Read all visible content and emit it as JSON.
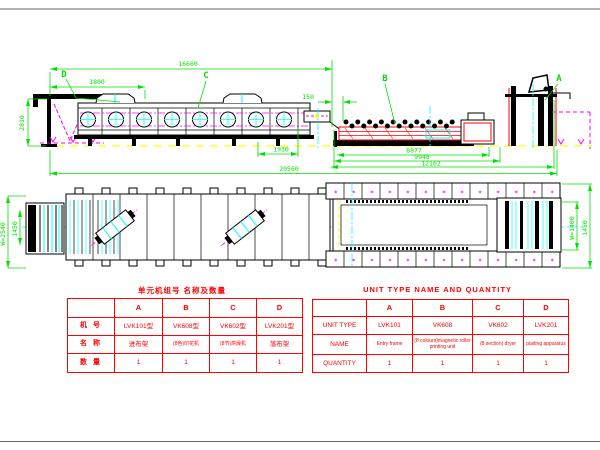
{
  "drawing": {
    "view_labels": {
      "a": "A",
      "b": "B",
      "c": "C",
      "d": "D"
    },
    "dimensions": {
      "overall_top": "16660",
      "entry_offset": "1800",
      "machine_height": "2810",
      "unit_gap": "150",
      "exit_length": "1930",
      "printing_length": "8877",
      "printing_overall": "9948",
      "right_group_overall": "12162",
      "overall_bottom": "20560",
      "plan_left_outer": "W=2540",
      "plan_left_inner": "1450",
      "plan_right_inner": "W=1400",
      "plan_right_outer": "1450"
    },
    "marks_row": "* * * * * * * * * * * * *"
  },
  "colors": {
    "dimension_green": "#00e000",
    "outline_black": "#000000",
    "table_red": "#ff0000",
    "path_magenta": "#ff00ff",
    "detail_cyan": "#00ffff",
    "ground_yellow": "#ffff00"
  },
  "tables": {
    "cn": {
      "title": "单元机组号 名称及数量",
      "col_headers": [
        "A",
        "B",
        "C",
        "D"
      ],
      "rows": [
        {
          "label": "机 号",
          "values": [
            "LVK101型",
            "VK608型",
            "VK602型",
            "LVK201型"
          ]
        },
        {
          "label": "名 称",
          "values": [
            "进布架",
            "(8色)印花机",
            "(8节)烘燥机",
            "落布架"
          ]
        },
        {
          "label": "数 量",
          "values": [
            "1",
            "1",
            "1",
            "1"
          ]
        }
      ]
    },
    "en": {
      "title": "UNIT TYPE NAME AND QUANTITY",
      "col_headers": [
        "A",
        "B",
        "C",
        "D"
      ],
      "rows": [
        {
          "label": "UNIT TYPE",
          "values": [
            "LVK101",
            "VK608",
            "VK602",
            "LVK201"
          ]
        },
        {
          "label": "NAME",
          "values": [
            "Entry frame",
            "(8 colours)magnetic roller printing unit",
            "(8 section) dryer",
            "plaiting apparatus"
          ]
        },
        {
          "label": "QUANTITY",
          "values": [
            "1",
            "1",
            "1",
            "1"
          ]
        }
      ]
    }
  }
}
